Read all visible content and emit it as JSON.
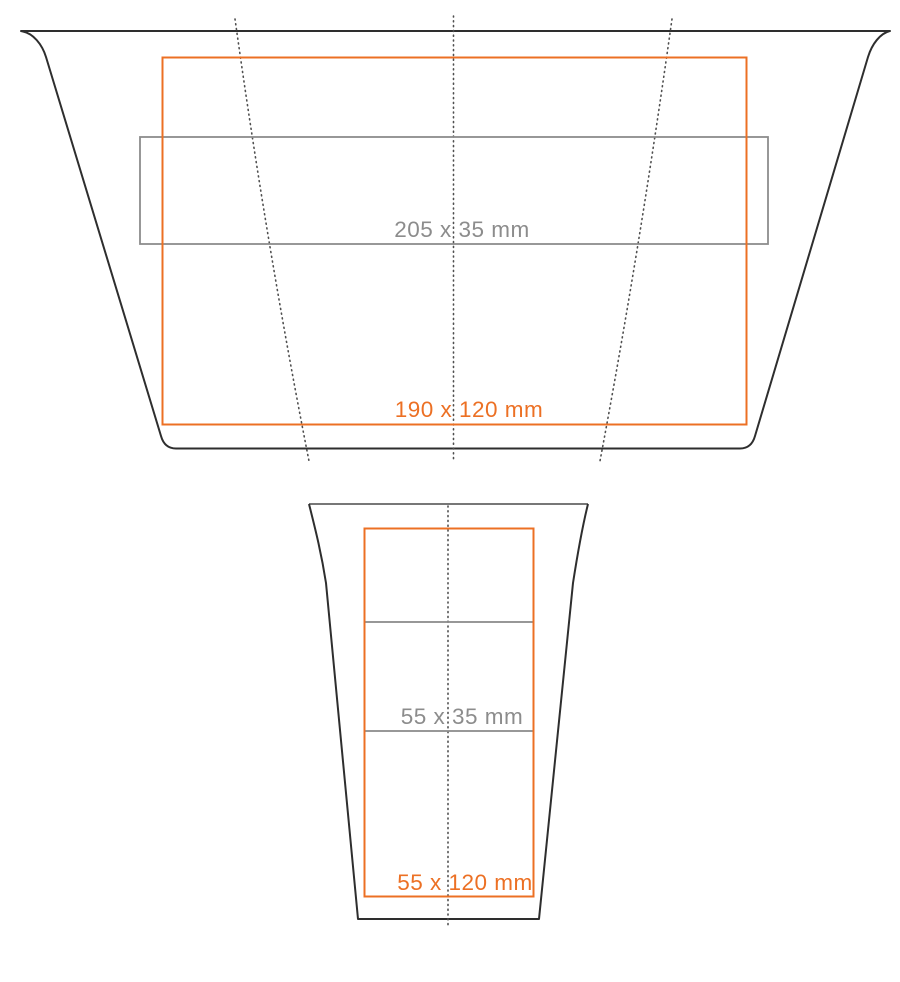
{
  "canvas": {
    "width_px": 900,
    "height_px": 982,
    "background": "#ffffff"
  },
  "colors": {
    "cup_outline": "#2e2e2e",
    "print_area_accent": "#ec7024",
    "safe_band_gray": "#8c8c8c",
    "seam_dotted_gray": "#4f4f4f"
  },
  "unrolled_view": {
    "description": "unrolled cup wrap development",
    "print_area_label": "190 x 120 mm",
    "print_band_label": "205 x 35 mm"
  },
  "front_view": {
    "description": "cup front elevation",
    "print_area_label": "55 x 120 mm",
    "print_band_label": "55 x 35 mm"
  }
}
